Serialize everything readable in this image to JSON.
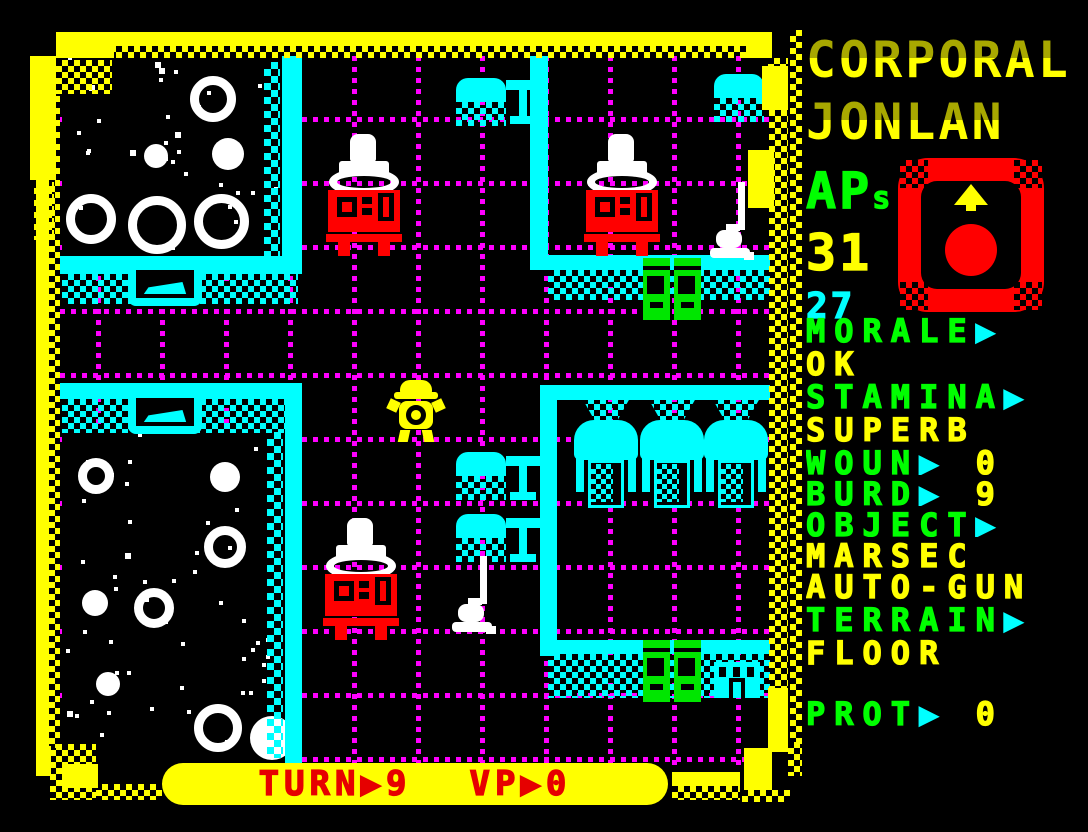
{
  "header": {
    "name_line1": "CORPORAL",
    "name_line2": "JONLAN"
  },
  "sidebar": {
    "ap_label": "AP",
    "ap_suffix": "s",
    "ap_value": "31",
    "ap_secondary": "27",
    "rows": [
      {
        "h": 33,
        "parts": [
          [
            "MORALE",
            "green"
          ],
          [
            "▶",
            "cyan"
          ]
        ]
      },
      {
        "h": 33,
        "parts": [
          [
            "OK",
            "yellow"
          ]
        ]
      },
      {
        "h": 33,
        "parts": [
          [
            "STAMINA",
            "green"
          ],
          [
            "▶",
            "cyan"
          ]
        ]
      },
      {
        "h": 33,
        "parts": [
          [
            "SUPERB",
            "yellow"
          ]
        ]
      },
      {
        "h": 31,
        "parts": [
          [
            "WOUN",
            "green"
          ],
          [
            "▶",
            "cyan"
          ],
          [
            " 0",
            "yellow"
          ]
        ]
      },
      {
        "h": 31,
        "parts": [
          [
            "BURD",
            "green"
          ],
          [
            "▶",
            "cyan"
          ],
          [
            " 9",
            "yellow"
          ]
        ]
      },
      {
        "h": 31,
        "parts": [
          [
            "OBJECT",
            "green"
          ],
          [
            "▶",
            "cyan"
          ]
        ]
      },
      {
        "h": 31,
        "parts": [
          [
            "MARSEC",
            "yellow"
          ]
        ]
      },
      {
        "h": 33,
        "parts": [
          [
            "AUTO-GUN",
            "yellow"
          ]
        ]
      },
      {
        "h": 33,
        "parts": [
          [
            "TERRAIN",
            "green"
          ],
          [
            "▶",
            "cyan"
          ]
        ]
      },
      {
        "h": 33,
        "parts": [
          [
            "FLOOR",
            "yellow"
          ]
        ]
      },
      {
        "h": 28,
        "parts": []
      },
      {
        "h": 33,
        "parts": [
          [
            "PROT",
            "green"
          ],
          [
            "▶",
            "cyan"
          ],
          [
            " 0",
            "yellow"
          ]
        ]
      }
    ],
    "facing_icon": "up"
  },
  "status_bar": {
    "turn_label": "TURN",
    "arrow": "▶",
    "turn_value": "9",
    "vp_label": "VP",
    "vp_value": "0"
  },
  "colors": {
    "yellow": "#ffff00",
    "green": "#00ff00",
    "cyan": "#00ffff",
    "magenta": "#ff00ff",
    "red": "#ff0000",
    "white": "#ffffff",
    "black": "#000000"
  },
  "map": {
    "grid": {
      "vx": [
        96,
        160,
        224,
        288,
        352,
        416,
        480,
        544,
        608,
        672,
        736
      ],
      "hy": [
        117,
        181,
        245,
        309,
        373,
        437,
        501,
        565,
        629,
        693,
        757
      ]
    },
    "objects": [
      {
        "t": "stars",
        "x": 62,
        "y": 56,
        "w": 220,
        "h": 202,
        "seed": 7,
        "moons": [
          {
            "x": 128,
            "y": 20,
            "d": 46,
            "ring": true
          },
          {
            "x": 82,
            "y": 88,
            "d": 24
          },
          {
            "x": 150,
            "y": 82,
            "d": 32
          },
          {
            "x": 4,
            "y": 138,
            "d": 50,
            "ring": true
          },
          {
            "x": 66,
            "y": 140,
            "d": 58,
            "ring": true
          },
          {
            "x": 132,
            "y": 138,
            "d": 55,
            "ring": true
          }
        ]
      },
      {
        "t": "stars",
        "x": 62,
        "y": 428,
        "w": 223,
        "h": 337,
        "seed": 13,
        "moons": [
          {
            "x": 16,
            "y": 30,
            "d": 36,
            "ring": true
          },
          {
            "x": 148,
            "y": 34,
            "d": 30
          },
          {
            "x": 142,
            "y": 98,
            "d": 42,
            "ring": true
          },
          {
            "x": 20,
            "y": 162,
            "d": 26
          },
          {
            "x": 72,
            "y": 160,
            "d": 40,
            "ring": true
          },
          {
            "x": 132,
            "y": 276,
            "d": 48,
            "ring": true
          },
          {
            "x": 34,
            "y": 244,
            "d": 24
          },
          {
            "x": 188,
            "y": 288,
            "d": 44
          }
        ]
      },
      {
        "t": "wallv",
        "x": 282,
        "y": 56,
        "w": 20,
        "h": 216
      },
      {
        "t": "ditherv",
        "x": 264,
        "y": 62,
        "w": 16,
        "h": 196
      },
      {
        "t": "wallh",
        "x": 55,
        "y": 256,
        "w": 247,
        "h": 18
      },
      {
        "t": "ditherh",
        "x": 62,
        "y": 274,
        "w": 236,
        "h": 30
      },
      {
        "t": "bed",
        "x": 128,
        "y": 262
      },
      {
        "t": "wallh",
        "x": 55,
        "y": 383,
        "w": 247,
        "h": 16
      },
      {
        "t": "ditherh",
        "x": 62,
        "y": 399,
        "w": 236,
        "h": 34
      },
      {
        "t": "bed",
        "x": 128,
        "y": 390
      },
      {
        "t": "wallv",
        "x": 285,
        "y": 383,
        "w": 17,
        "h": 382
      },
      {
        "t": "ditherv",
        "x": 267,
        "y": 432,
        "w": 16,
        "h": 326
      },
      {
        "t": "wallv",
        "x": 530,
        "y": 56,
        "w": 18,
        "h": 212
      },
      {
        "t": "wallh",
        "x": 530,
        "y": 255,
        "w": 258,
        "h": 15
      },
      {
        "t": "ditherh",
        "x": 548,
        "y": 270,
        "w": 236,
        "h": 30
      },
      {
        "t": "wallh",
        "x": 540,
        "y": 385,
        "w": 248,
        "h": 15
      },
      {
        "t": "wallv",
        "x": 540,
        "y": 398,
        "w": 17,
        "h": 258
      },
      {
        "t": "wallh",
        "x": 540,
        "y": 640,
        "w": 248,
        "h": 14
      },
      {
        "t": "ditherh",
        "x": 548,
        "y": 654,
        "w": 236,
        "h": 44
      },
      {
        "t": "chair",
        "x": 456,
        "y": 78
      },
      {
        "t": "sidetable",
        "x": 506,
        "y": 80
      },
      {
        "t": "chair",
        "x": 714,
        "y": 74
      },
      {
        "t": "figure",
        "x": 326,
        "y": 134
      },
      {
        "t": "figure",
        "x": 584,
        "y": 134
      },
      {
        "t": "lamp",
        "x": 710,
        "y": 182
      },
      {
        "t": "doors",
        "x": 643,
        "y": 258
      },
      {
        "t": "tank",
        "x": 574,
        "y": 398
      },
      {
        "t": "tank",
        "x": 640,
        "y": 398
      },
      {
        "t": "tank",
        "x": 704,
        "y": 398
      },
      {
        "t": "chair",
        "x": 456,
        "y": 452
      },
      {
        "t": "sidetable",
        "x": 506,
        "y": 456
      },
      {
        "t": "chair",
        "x": 456,
        "y": 514
      },
      {
        "t": "sidetable",
        "x": 506,
        "y": 518
      },
      {
        "t": "figure",
        "x": 323,
        "y": 518
      },
      {
        "t": "lamp",
        "x": 452,
        "y": 556
      },
      {
        "t": "doors",
        "x": 643,
        "y": 640
      },
      {
        "t": "building",
        "x": 714,
        "y": 662
      },
      {
        "t": "player",
        "x": 390,
        "y": 380
      }
    ]
  }
}
